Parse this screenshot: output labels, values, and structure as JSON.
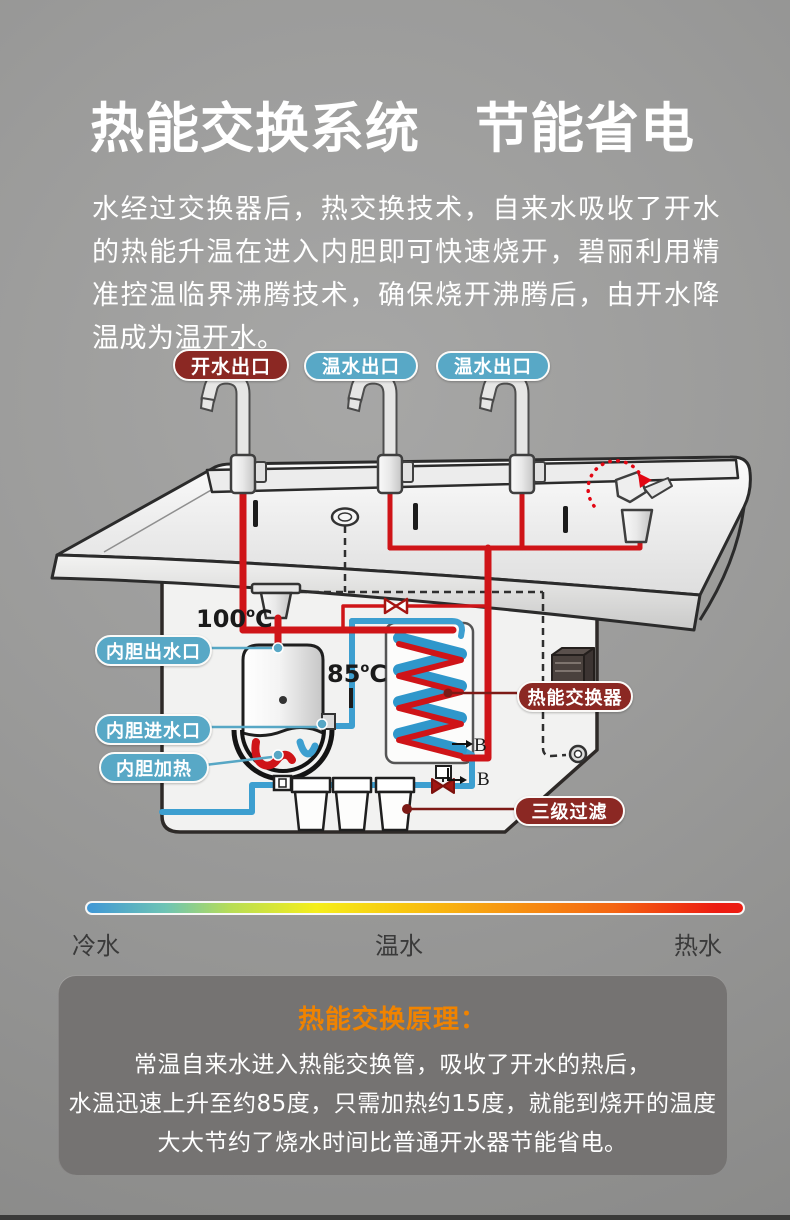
{
  "header": {
    "title": "热能交换系统　节能省电",
    "intro": "水经过交换器后，热交换技术，自来水吸收了开水的热能升温在进入内胆即可快速烧开，碧丽利用精准控温临界沸腾技术，确保烧开沸腾后，由开水降温成为温开水。"
  },
  "diagram": {
    "outlets": [
      {
        "label": "开水出口",
        "type": "boiling"
      },
      {
        "label": "温水出口",
        "type": "warm"
      },
      {
        "label": "温水出口",
        "type": "warm"
      }
    ],
    "labels": {
      "tank_outlet": "内胆出水口",
      "tank_inlet": "内胆进水口",
      "tank_heater": "内胆加热",
      "heat_exchanger": "热能交换器",
      "filters": "三级过滤"
    },
    "temperatures": {
      "boiling_value": "100",
      "warm_value": "85",
      "degree_symbol": "o",
      "unit": "C"
    },
    "section_marks": {
      "b1": "B",
      "b2": "B"
    },
    "colors": {
      "hot_pipe": "#cf1418",
      "cold_pipe": "#3d9fd0",
      "hot_label_bg": "#8b2823",
      "cold_label_bg": "#58a8c6"
    }
  },
  "legend": {
    "cold": "冷水",
    "warm": "温水",
    "hot": "热水"
  },
  "principle": {
    "title": "热能交换原理：",
    "line1": "常温自来水进入热能交换管，吸收了开水的热后，",
    "line2": "水温迅速上升至约85度，只需加热约15度，就能到烧开的温度",
    "line3": "大大节约了烧水时间比普通开水器节能省电。"
  }
}
